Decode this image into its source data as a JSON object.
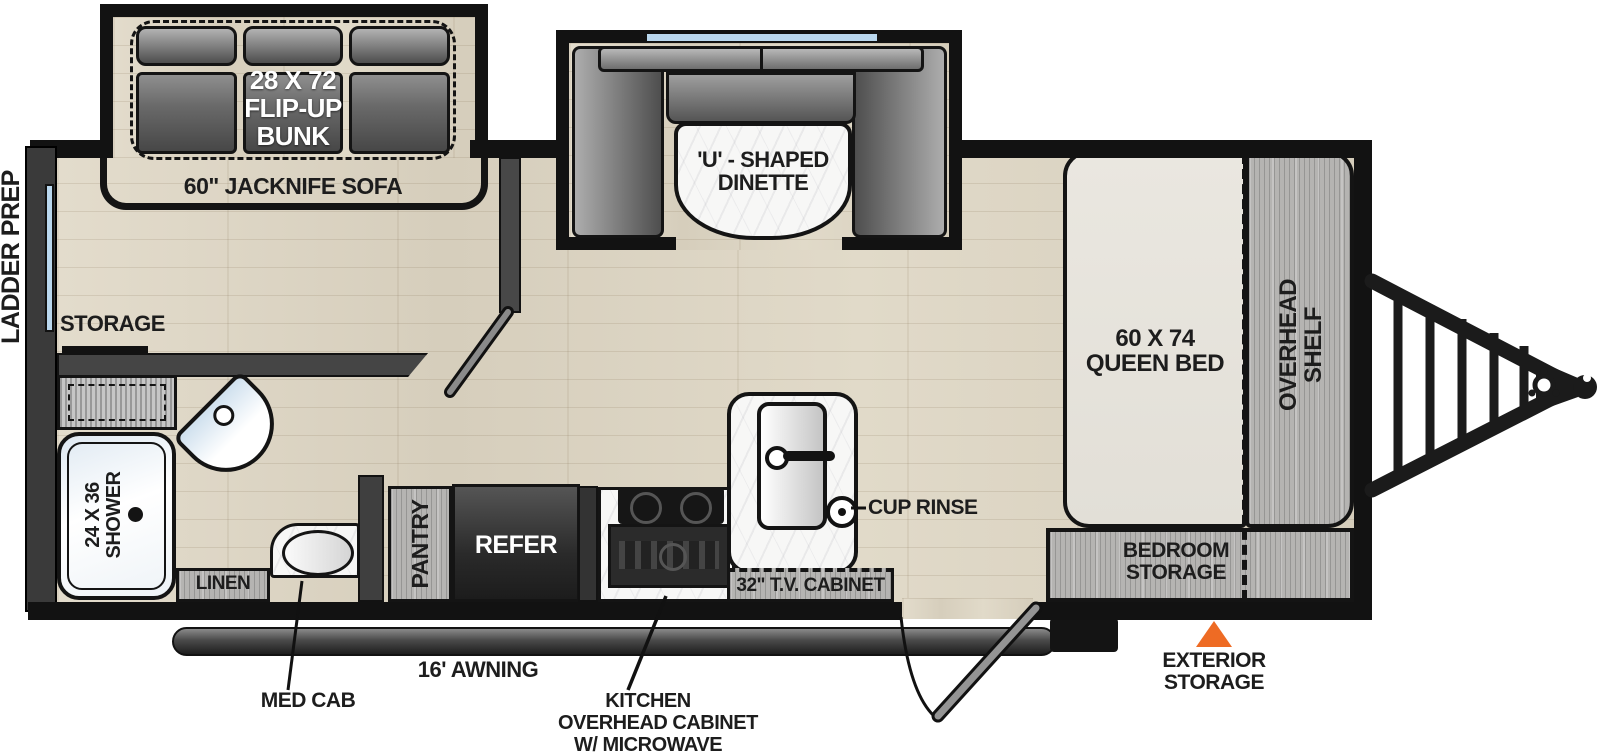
{
  "diagram_type": "travel-trailer floorplan",
  "labels": {
    "ladder_prep": "LADDER PREP",
    "flip_up_bunk": {
      "line1": "28 X 72",
      "line2": "FLIP-UP",
      "line3": "BUNK"
    },
    "jacknife_sofa": "60\" JACKNIFE SOFA",
    "dinette": {
      "line1": "'U' - SHAPED",
      "line2": "DINETTE"
    },
    "storage": "STORAGE",
    "shower": {
      "line1": "24 X 36",
      "line2": "SHOWER"
    },
    "linen": "LINEN",
    "med_cab": "MED CAB",
    "pantry": "PANTRY",
    "refer": "REFER",
    "awning": "16' AWNING",
    "kitchen_overhead": {
      "line1": "KITCHEN",
      "line2": "OVERHEAD CABINET",
      "line3": "W/ MICROWAVE"
    },
    "cup_rinse": "CUP RINSE",
    "tv_cabinet": "32\" T.V. CABINET",
    "queen_bed": {
      "line1": "60 X 74",
      "line2": "QUEEN BED"
    },
    "overhead_shelf": {
      "line1": "OVERHEAD",
      "line2": "SHELF"
    },
    "bedroom_storage": {
      "line1": "BEDROOM",
      "line2": "STORAGE"
    },
    "exterior_storage": {
      "line1": "EXTERIOR",
      "line2": "STORAGE"
    }
  },
  "colors": {
    "accent_orange": "#EE6B24",
    "window_blue": "#B9D7EE",
    "wall_black": "#121212",
    "floor_wood": "#DCD4C4",
    "cabinet_gray": "#B5B4B2"
  }
}
